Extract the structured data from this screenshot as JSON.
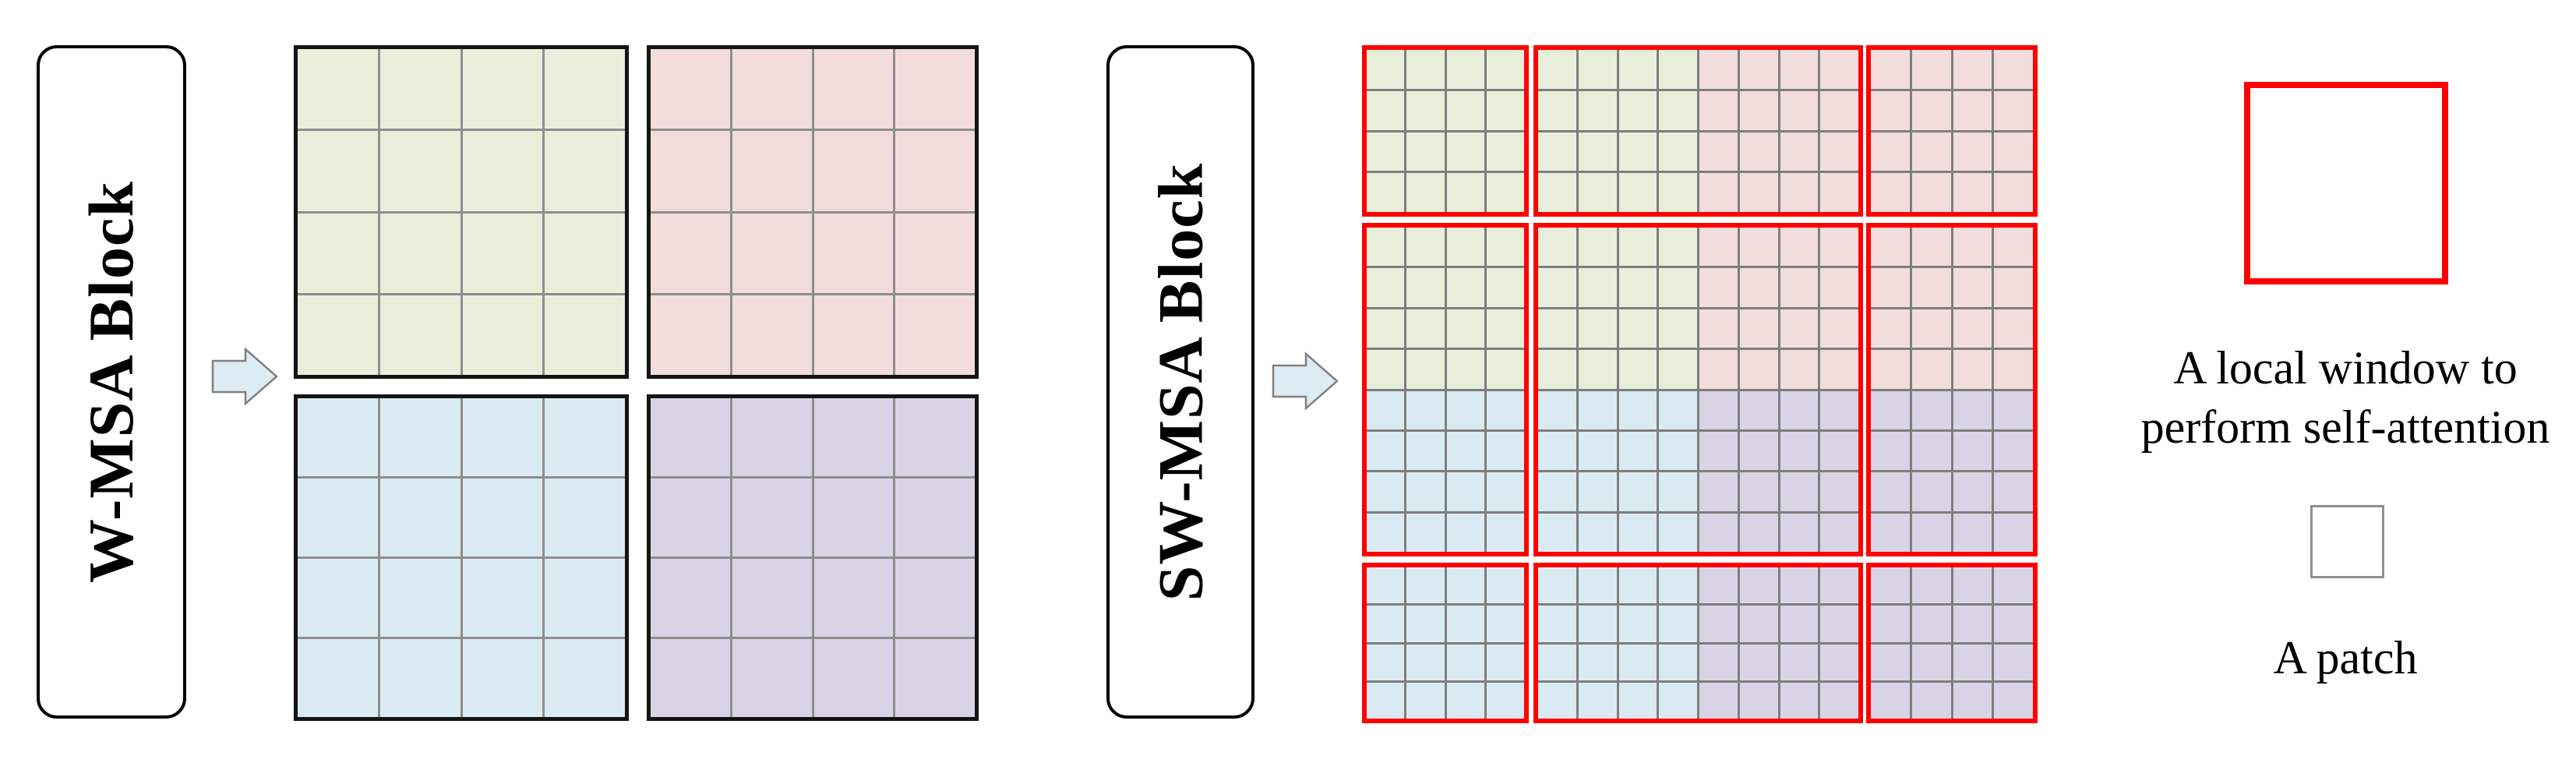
{
  "blocks": {
    "wmsa_label": "W-MSA Block",
    "swmsa_label": "SW-MSA Block"
  },
  "palette": {
    "green": "#e9eeda",
    "pink": "#f3dcdc",
    "blue": "#d9eaf2",
    "purple": "#d8d4e5",
    "window_outline_black": "#141414",
    "window_outline_red": "#ff0000",
    "patch_line_light": "#8e8e8e",
    "patch_line_dark": "#7e7e7e",
    "arrow_fill": "#dcebf4",
    "arrow_outline": "#808080",
    "patch_legend_outline": "#8f8f8f"
  },
  "wmsa_grid": {
    "windows": [
      {
        "position": "top-left",
        "color": "green",
        "patch_rows": 4,
        "patch_cols": 4
      },
      {
        "position": "top-right",
        "color": "pink",
        "patch_rows": 4,
        "patch_cols": 4
      },
      {
        "position": "bottom-left",
        "color": "blue",
        "patch_rows": 4,
        "patch_cols": 4
      },
      {
        "position": "bottom-right",
        "color": "purple",
        "patch_rows": 4,
        "patch_cols": 4
      }
    ]
  },
  "swmsa_grid": {
    "windows": [
      {
        "row": 0,
        "col": 0,
        "patch_rows": 4,
        "patch_cols": 4,
        "quads": {
          "tl": "green",
          "tr": "green",
          "bl": "green",
          "br": "green"
        }
      },
      {
        "row": 0,
        "col": 1,
        "patch_rows": 4,
        "patch_cols": 8,
        "quads": {
          "tl": "green",
          "tr": "pink",
          "bl": "green",
          "br": "pink"
        }
      },
      {
        "row": 0,
        "col": 2,
        "patch_rows": 4,
        "patch_cols": 4,
        "quads": {
          "tl": "pink",
          "tr": "pink",
          "bl": "pink",
          "br": "pink"
        }
      },
      {
        "row": 1,
        "col": 0,
        "patch_rows": 8,
        "patch_cols": 4,
        "quads": {
          "tl": "green",
          "tr": "green",
          "bl": "blue",
          "br": "blue"
        }
      },
      {
        "row": 1,
        "col": 1,
        "patch_rows": 8,
        "patch_cols": 8,
        "quads": {
          "tl": "green",
          "tr": "pink",
          "bl": "blue",
          "br": "purple"
        }
      },
      {
        "row": 1,
        "col": 2,
        "patch_rows": 8,
        "patch_cols": 4,
        "quads": {
          "tl": "pink",
          "tr": "pink",
          "bl": "purple",
          "br": "purple"
        }
      },
      {
        "row": 2,
        "col": 0,
        "patch_rows": 4,
        "patch_cols": 4,
        "quads": {
          "tl": "blue",
          "tr": "blue",
          "bl": "blue",
          "br": "blue"
        }
      },
      {
        "row": 2,
        "col": 1,
        "patch_rows": 4,
        "patch_cols": 8,
        "quads": {
          "tl": "blue",
          "tr": "purple",
          "bl": "blue",
          "br": "purple"
        }
      },
      {
        "row": 2,
        "col": 2,
        "patch_rows": 4,
        "patch_cols": 4,
        "quads": {
          "tl": "purple",
          "tr": "purple",
          "bl": "purple",
          "br": "purple"
        }
      }
    ]
  },
  "legend": {
    "window_label_line1": "A local window to",
    "window_label_line2": "perform self-attention",
    "patch_label": "A patch"
  }
}
